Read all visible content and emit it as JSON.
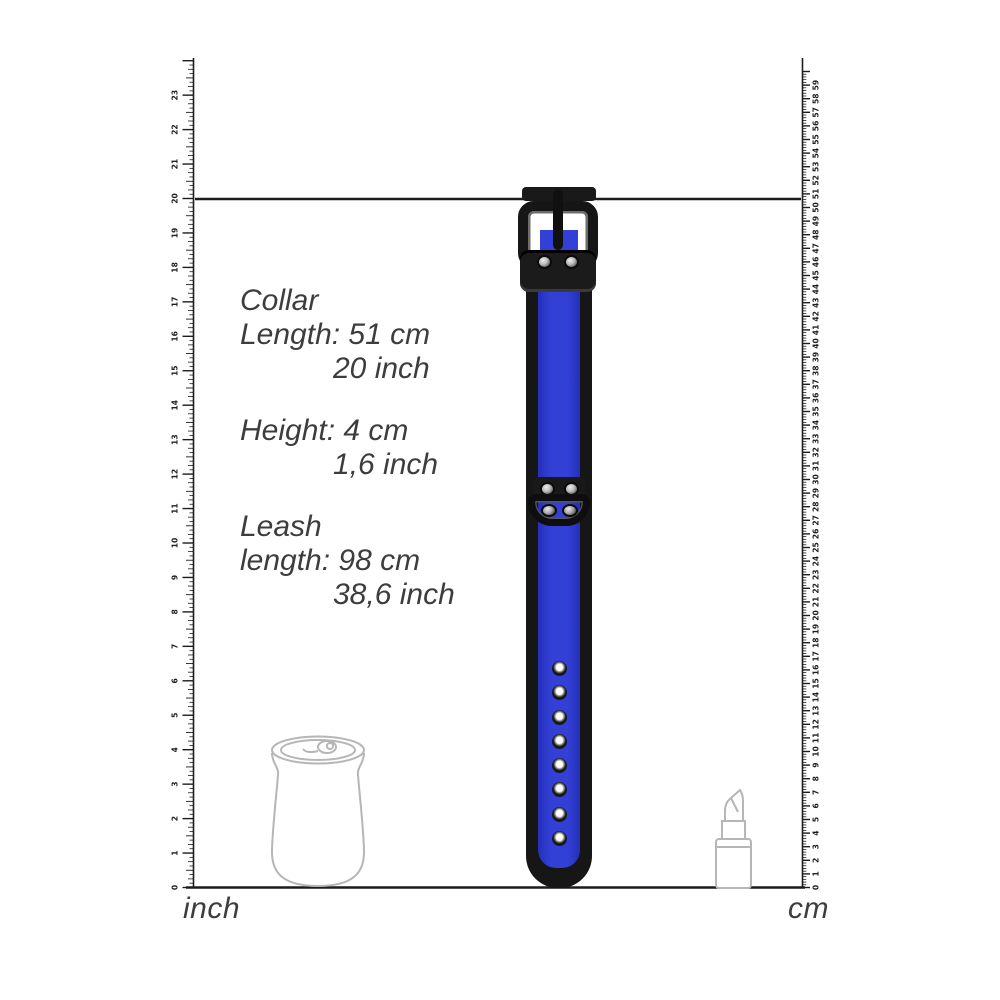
{
  "rulers": {
    "left": {
      "label": "inch",
      "units": 24,
      "numbered_max": 23,
      "subdivisions": 8
    },
    "right": {
      "label": "cm",
      "units": 60,
      "numbered_max": 59,
      "subdivisions": 5
    }
  },
  "specs": {
    "collar": {
      "title": "Collar",
      "metric": "Length: 51 cm",
      "imperial": "20 inch"
    },
    "height": {
      "metric": "Height: 4 cm",
      "imperial": "1,6 inch"
    },
    "leash": {
      "title": "Leash",
      "metric": "length: 98 cm",
      "imperial": "38,6 inch"
    }
  },
  "collar": {
    "hole_count": 8,
    "marked_length_inch": 20
  },
  "reference_objects": [
    "soda-can",
    "lipstick"
  ],
  "colors": {
    "collar_blue": "#3340d6",
    "collar_black": "#161616",
    "outline_gray": "#b6b6b6",
    "text_gray": "#3d3d3d",
    "ruler_ink": "#1c1c1c"
  }
}
